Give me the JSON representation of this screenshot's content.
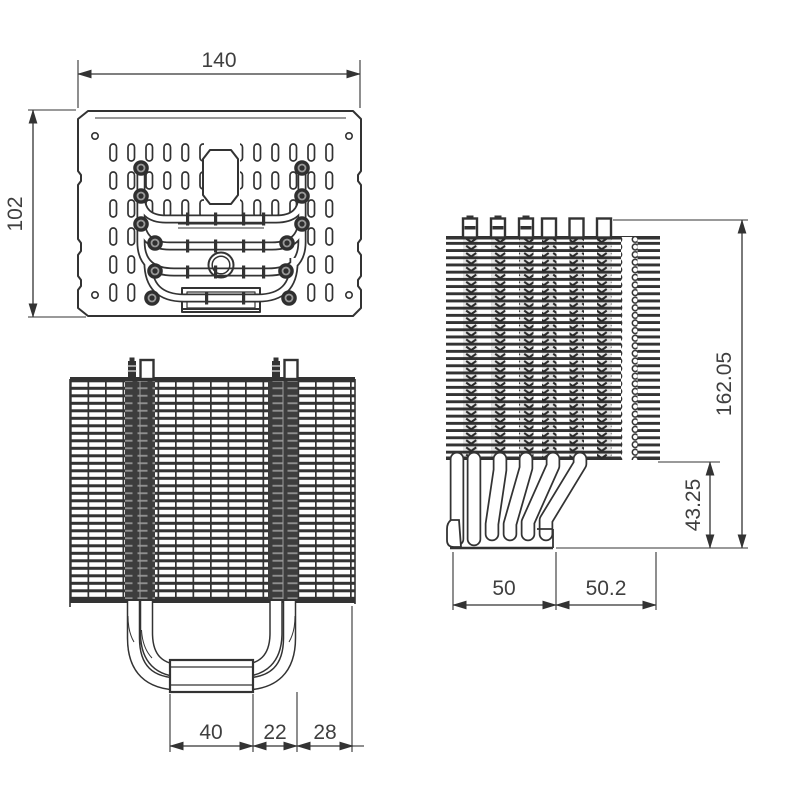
{
  "colors": {
    "line": "#333333",
    "background": "#ffffff",
    "label": "#3f3f3f",
    "pipe_dark": "#3d3d3d",
    "stripe_light": "#8f8f8f"
  },
  "views": {
    "top": {
      "width": "140",
      "height": "102"
    },
    "front": {
      "base_width": "40",
      "pipe_span": "22",
      "edge_offset": "28"
    },
    "side": {
      "total_height": "162.05",
      "base_height": "43.25",
      "front_depth": "50",
      "rear_depth": "50.2"
    }
  }
}
